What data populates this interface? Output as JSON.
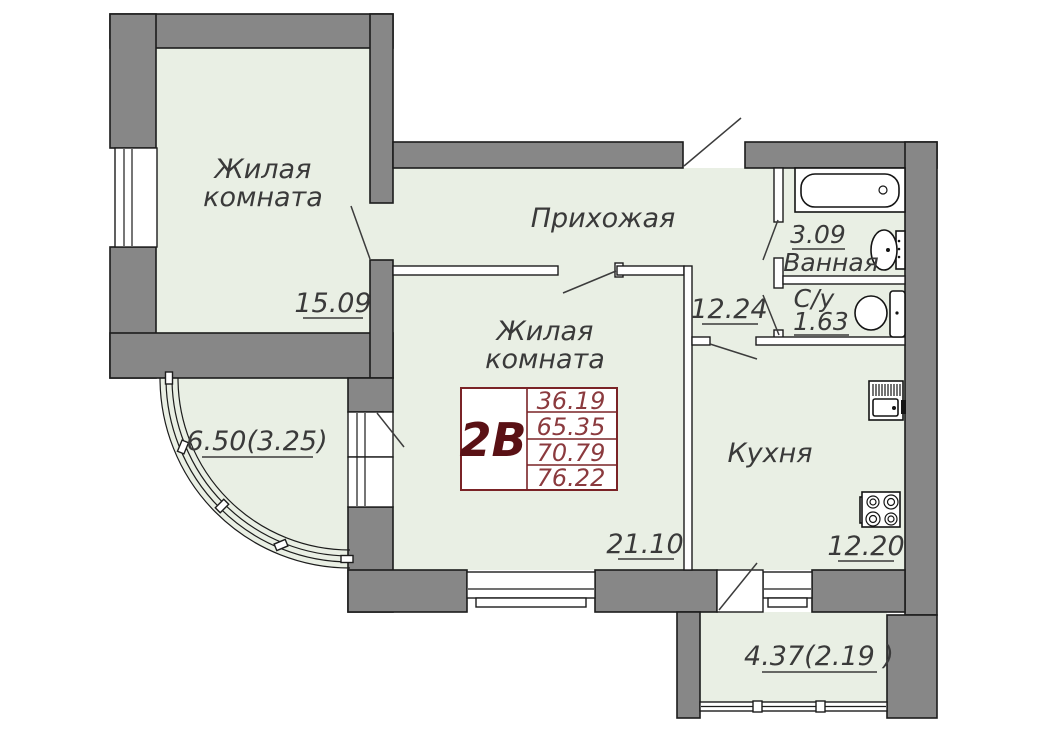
{
  "plan": {
    "unit_box": {
      "unit": "2В",
      "values": [
        "36.19",
        "65.35",
        "70.79",
        "76.22"
      ]
    },
    "rooms": {
      "room1": {
        "line1": "Жилая",
        "line2": "комната",
        "area": "15.09"
      },
      "hall": {
        "label": "Прихожая",
        "area": "12.24"
      },
      "bath": {
        "label": "Ванная",
        "area": "3.09"
      },
      "wc": {
        "label": "С/у",
        "area": "1.63"
      },
      "room2": {
        "line1": "Жилая",
        "line2": "комната",
        "area": "21.10"
      },
      "kitchen": {
        "label": "Кухня",
        "area": "12.20"
      },
      "balcony_left": {
        "area": "6.50(3.25)"
      },
      "balcony_bottom": {
        "area": "4.37(2.19 )"
      }
    },
    "colors": {
      "wall": "#878787",
      "floor": "#e9efe4",
      "accent": "#7a2326"
    }
  }
}
